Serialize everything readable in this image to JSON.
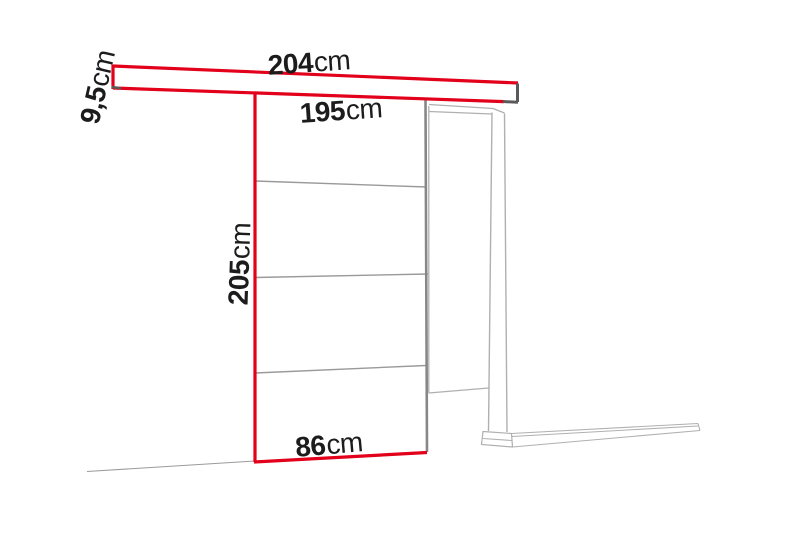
{
  "diagram": {
    "title": "sliding-door-dimension-diagram",
    "labels": {
      "rail_length": {
        "value": "204",
        "unit": "cm"
      },
      "rail_height": {
        "value": "9,5",
        "unit": "cm"
      },
      "track_width": {
        "value": "195",
        "unit": "cm"
      },
      "door_height": {
        "value": "205",
        "unit": "cm"
      },
      "door_width": {
        "value": "86",
        "unit": "cm"
      }
    },
    "colors": {
      "highlight_red": "#e2001a",
      "dark_gray": "#5a5a5a",
      "line_gray": "#9a9a9a",
      "door_edge_gray": "#878787",
      "frame_gray": "#b0b0b0",
      "text_black": "#1c1c1c",
      "background": "#ffffff"
    }
  }
}
